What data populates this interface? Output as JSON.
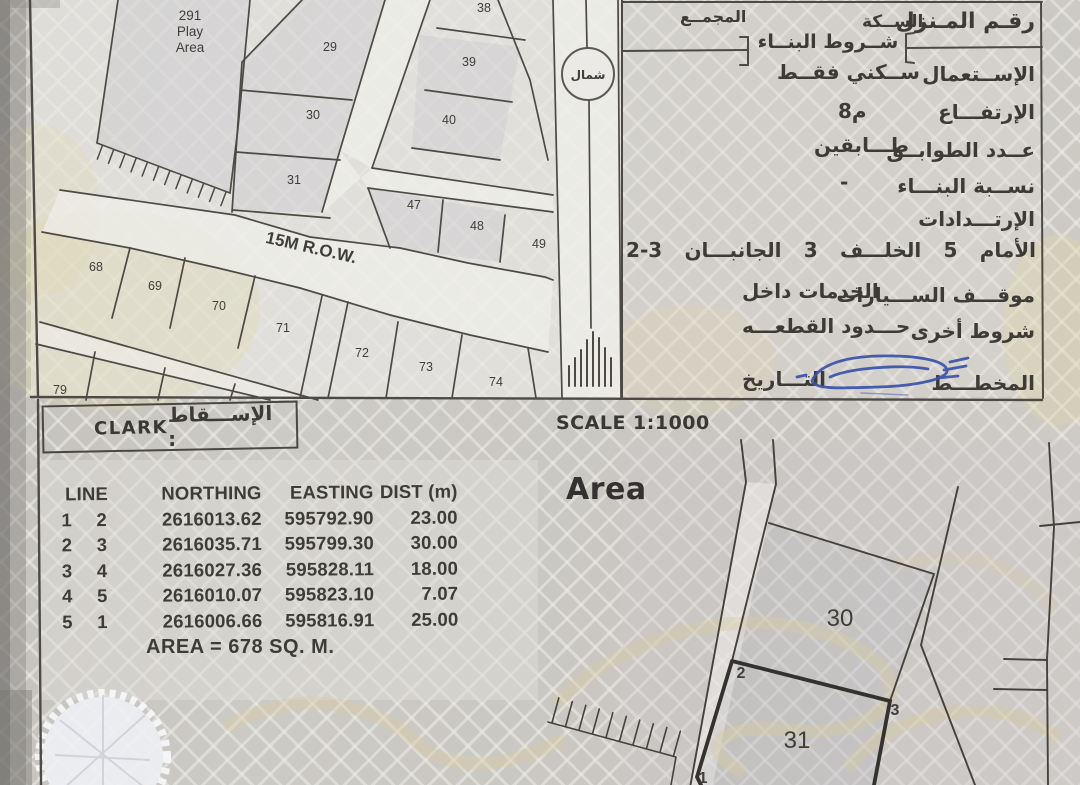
{
  "info_panel": {
    "house_number_label": "رقـم المـنزل",
    "street_label": "الســكة",
    "complex_label": "المجمــع",
    "building_conditions_title": "شــروط البنــاء",
    "usage": {
      "label": "الإســتعمال",
      "value": "ســكني فقــط"
    },
    "height": {
      "label": "الإرتفـــاع",
      "value": "8م"
    },
    "floors": {
      "label": "عــدد الطوابــق",
      "value": "طـــابقين"
    },
    "building_ratio": {
      "label": "نســبة البنـــاء",
      "value": "-"
    },
    "setbacks_label": "الإرتـــدادات",
    "setbacks": {
      "front_label": "الأمام",
      "front": "5",
      "back_label": "الخلـــف",
      "back": "3",
      "sides_label": "الجانبـــان",
      "sides": "2-3"
    },
    "parking": {
      "label": "موقـــف الســـيارات",
      "value": "الخدمات داخل"
    },
    "other_conditions": {
      "label": "شروط أخرى",
      "value": "حـــدود القطعـــه"
    },
    "plan_label": "المخطـــط",
    "date_label": "التـــاريخ"
  },
  "projection": {
    "label": "الإســـقاط :",
    "value": "CLARK"
  },
  "scale_text": "SCALE 1:1000",
  "map": {
    "north_label": "شمال",
    "row_label": "15M R.O.W.",
    "play_area": {
      "line1": "291",
      "line2": "Play",
      "line3": "Area"
    },
    "plots": {
      "n29": "29",
      "n30": "30",
      "n31": "31",
      "n38": "38",
      "n39": "39",
      "n40": "40",
      "n47": "47",
      "n48": "48",
      "n49": "49",
      "n68": "68",
      "n69": "69",
      "n70": "70",
      "n71": "71",
      "n72": "72",
      "n73": "73",
      "n74": "74",
      "n79": "79"
    }
  },
  "detail": {
    "title": "Area",
    "plot30": "30",
    "plot31": "31",
    "corner1": "1",
    "corner2": "2",
    "corner3": "3"
  },
  "table": {
    "headers": {
      "line": "LINE",
      "northing": "NORTHING",
      "easting": "EASTING",
      "dist": "DIST (m)"
    },
    "rows": [
      {
        "from": "1",
        "to": "2",
        "northing": "2616013.62",
        "easting": "595792.90",
        "dist": "23.00"
      },
      {
        "from": "2",
        "to": "3",
        "northing": "2616035.71",
        "easting": "595799.30",
        "dist": "30.00"
      },
      {
        "from": "3",
        "to": "4",
        "northing": "2616027.36",
        "easting": "595828.11",
        "dist": "18.00"
      },
      {
        "from": "4",
        "to": "5",
        "northing": "2616010.07",
        "easting": "595823.10",
        "dist": "7.07"
      },
      {
        "from": "5",
        "to": "1",
        "northing": "2616006.66",
        "easting": "595816.91",
        "dist": "25.00"
      }
    ],
    "area_note": "AREA = 678 SQ. M."
  },
  "colors": {
    "signature_blue": "#3a52aa",
    "paper": "#c7c4bf",
    "line_ink": "#4d4a45"
  }
}
